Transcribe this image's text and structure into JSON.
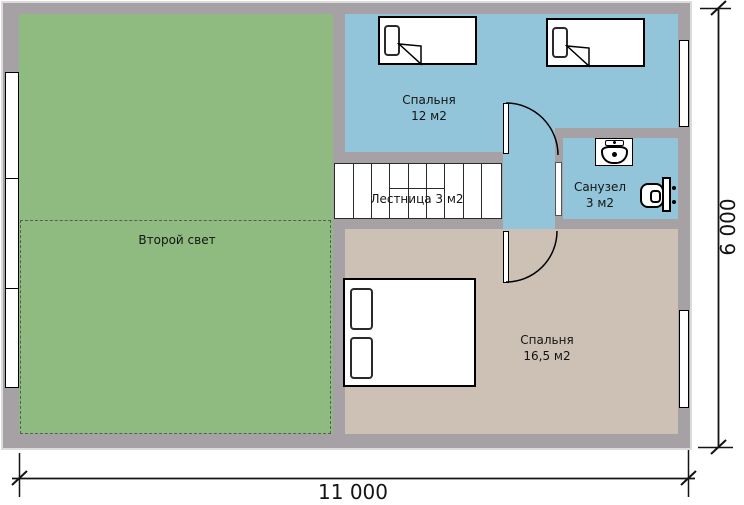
{
  "plan_title": "Floor plan, second storey",
  "rooms": {
    "second_light": {
      "label": "Второй свет"
    },
    "bedroom_small": {
      "label": "Спальня",
      "area": "12 м2"
    },
    "staircase": {
      "label": "Лестница 3 м2"
    },
    "bathroom": {
      "label": "Санузел",
      "area": "3 м2"
    },
    "bedroom_large": {
      "label": "Спальня",
      "area": "16,5 м2"
    }
  },
  "dimensions": {
    "width_label": "11 000",
    "height_label": "6 000"
  },
  "colors": {
    "wall": "#a5a1a5",
    "second_light_fill": "#8fbb81",
    "bedroom_small_fill": "#92c5d9",
    "bathroom_fill": "#92c5d9",
    "bedroom_large_fill": "#cdc1b5",
    "stair_fill": "#ffffff",
    "line": "#141414"
  }
}
